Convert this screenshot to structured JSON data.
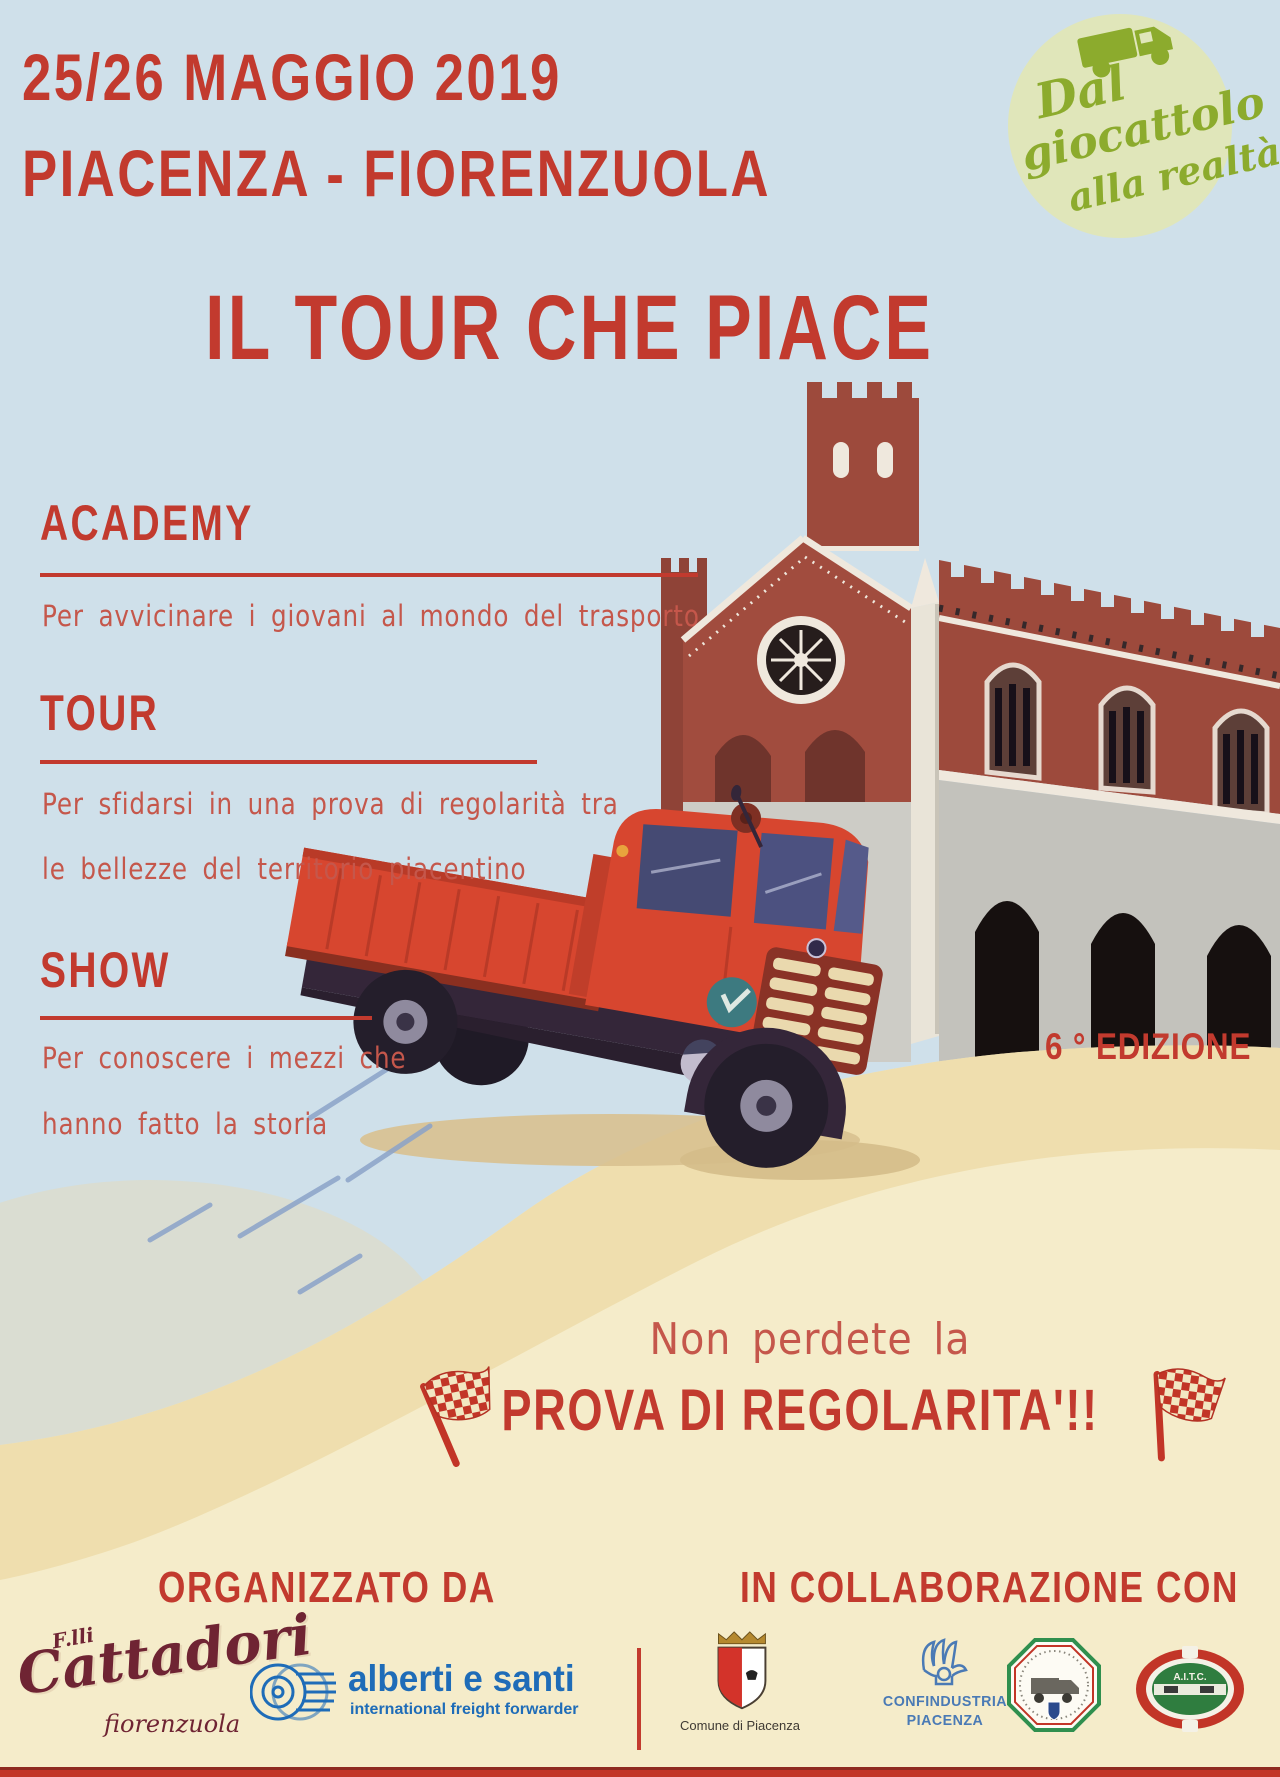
{
  "poster": {
    "header": {
      "date_line": "25/26 MAGGIO 2019",
      "route_line": "PIACENZA - FIORENZUOLA"
    },
    "badge": {
      "line1": "Dal",
      "line2": "giocattolo",
      "line3": "alla realtà"
    },
    "title": "IL TOUR CHE PIACE",
    "sections": [
      {
        "heading": "ACADEMY",
        "lines": [
          "Per avvicinare i giovani al mondo del trasporto"
        ]
      },
      {
        "heading": "TOUR",
        "lines": [
          "Per sfidarsi in una prova di regolarità tra",
          "le bellezze del territorio piacentino"
        ]
      },
      {
        "heading": "SHOW",
        "lines": [
          "Per conoscere i mezzi che",
          "hanno fatto la storia"
        ]
      }
    ],
    "edition_label": "6 ° EDIZIONE",
    "callout": {
      "intro": "Non perdete la",
      "main": "PROVA DI REGOLARITA'!!"
    },
    "footer": {
      "left_heading": "ORGANIZZATO DA",
      "right_heading": "IN COLLABORAZIONE CON",
      "cattadori": {
        "prefix": "F.lli",
        "name": "Cattadori",
        "city": "fiorenzuola"
      },
      "alberti": {
        "name": "alberti e santi",
        "tagline": "international freight forwarder"
      },
      "comune_caption": "Comune di Piacenza",
      "confindustria_line1": "CONFINDUSTRIA",
      "confindustria_line2": "PIACENZA",
      "aite_label": "A.I.T.C."
    },
    "colors": {
      "accent_red": "#c23a2e",
      "body_red": "#c5574b",
      "sky_blue": "#cfe0ea",
      "cream": "#f5ecca",
      "sand": "#ecd9a4",
      "badge_green": "#8cab2d",
      "badge_circle_bg": "#e0e6ba",
      "truck_red": "#d7462f",
      "brick_red": "#9d4a3c",
      "alberti_blue": "#1e6cb8"
    }
  }
}
